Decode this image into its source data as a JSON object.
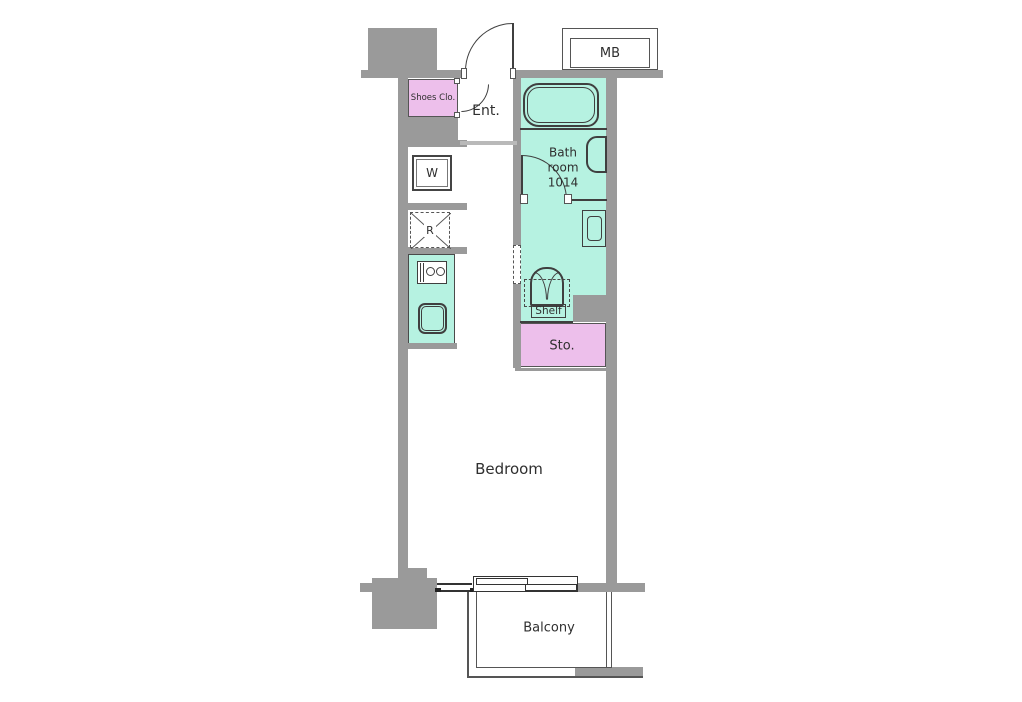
{
  "labels": {
    "mb": "MB",
    "shoes_closet": "Shoes Clo.",
    "entrance": "Ent.",
    "bath_line1": "Bath",
    "bath_line2": "room",
    "bath_line3": "1014",
    "washer": "W",
    "fridge": "R",
    "shelf": "Shelf",
    "storage": "Sto.",
    "bedroom": "Bedroom",
    "balcony": "Balcony"
  },
  "colors": {
    "wall": "#9a9a9a",
    "wall-edge": "#7c7c7c",
    "wet-area": "#b6f2e1",
    "closet": "#edbfeb",
    "line": "#3f3f3f"
  }
}
